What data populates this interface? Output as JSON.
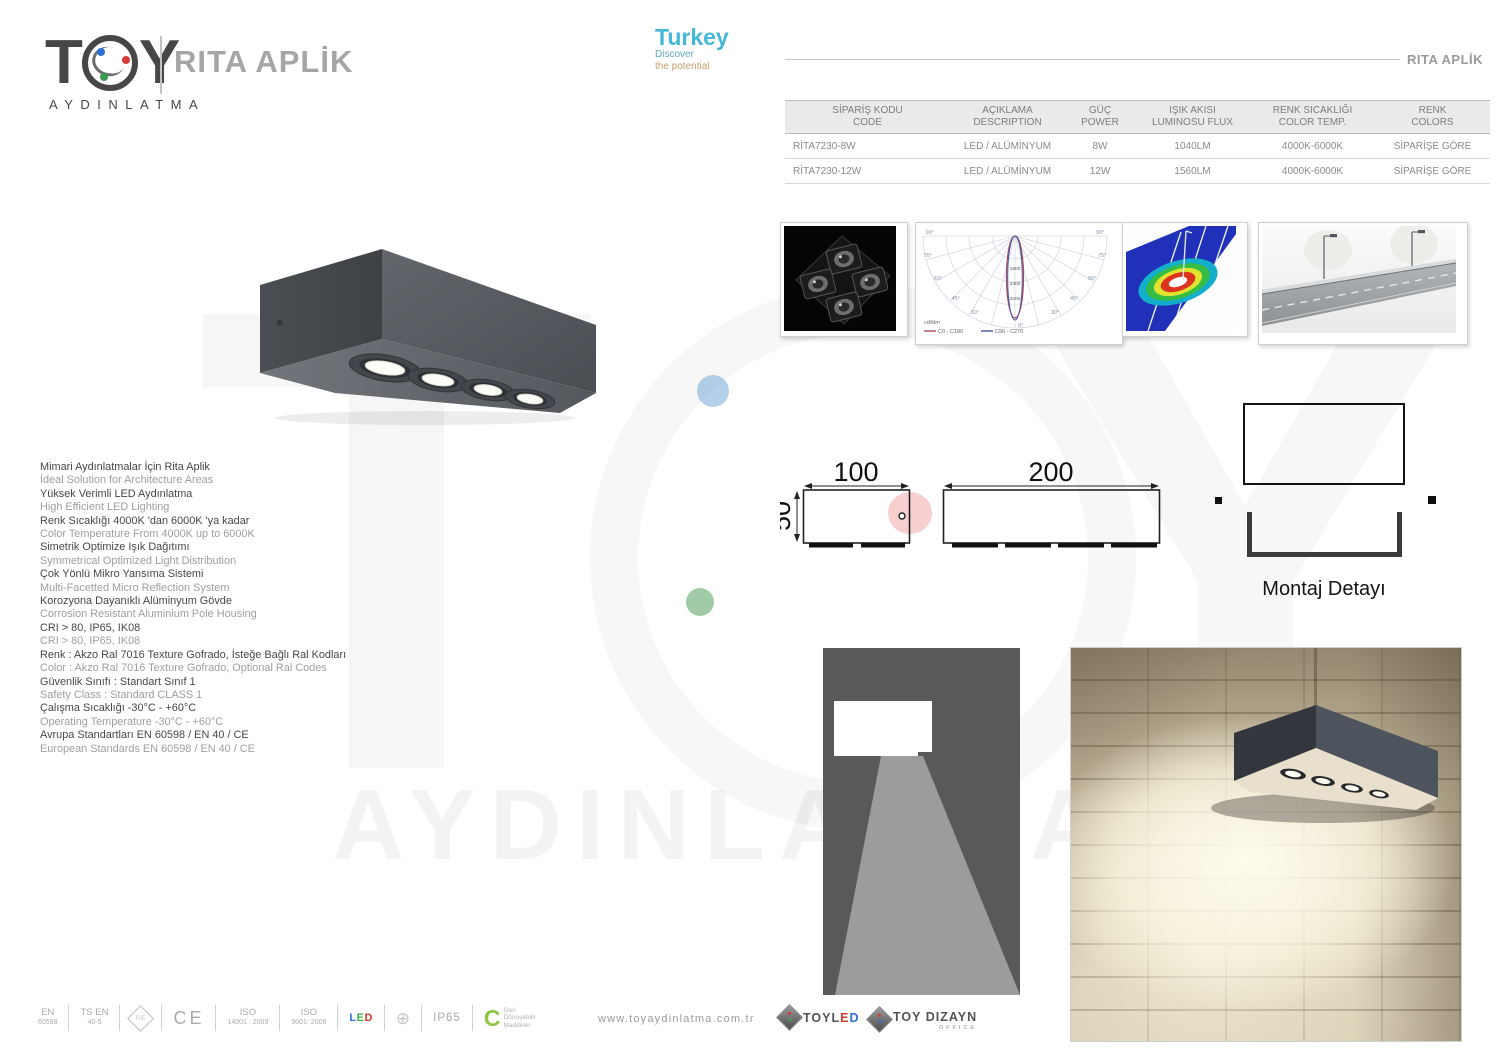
{
  "header": {
    "brand_t": "T",
    "brand_y": "Y",
    "brand_sub": "AYDINLATMA",
    "product_title": "RITA APLİK",
    "top_right_label": "RITA APLİK",
    "turkey": {
      "title": "Turkey",
      "tagline1": "Discover",
      "tagline2": "the potential"
    }
  },
  "spec_table": {
    "headers": [
      {
        "tr": "SİPARİŞ KODU",
        "en": "CODE"
      },
      {
        "tr": "AÇIKLAMA",
        "en": "DESCRIPTION"
      },
      {
        "tr": "GÜÇ",
        "en": "POWER"
      },
      {
        "tr": "IŞIK AKISI",
        "en": "LUMINOSU FLUX"
      },
      {
        "tr": "RENK SICAKLIĞI",
        "en": "COLOR TEMP."
      },
      {
        "tr": "RENK",
        "en": "COLORS"
      }
    ],
    "rows": [
      [
        "RİTA7230-8W",
        "LED / ALÜMİNYUM",
        "8W",
        "1040LM",
        "4000K-6000K",
        "SİPARİŞE GÖRE"
      ],
      [
        "RİTA7230-12W",
        "LED / ALÜMİNYUM",
        "12W",
        "1560LM",
        "4000K-6000K",
        "SİPARİŞE GÖRE"
      ]
    ]
  },
  "polar_chart": {
    "type": "polar-photometric",
    "unit": "cd/klm",
    "l90": "90°",
    "l75": "75°",
    "l60": "60°",
    "l45": "45°",
    "l30": "30°",
    "l0": "0°",
    "v1": "1600",
    "v2": "2400",
    "v3": "3200",
    "legend1": "C0 - C180",
    "legend2": "C90 - C270",
    "legend1_color": "#a94758",
    "legend2_color": "#4455a8"
  },
  "features": [
    {
      "t": "Mimari Aydınlatmalar İçin Rita Aplik"
    },
    {
      "t": "İdeal Solution for Architecture Areas"
    },
    {
      "t": "Yüksek Verimli LED Aydınlatma"
    },
    {
      "t": "High Efficient LED Lighting"
    },
    {
      "t": "Renk Sıcaklığı 4000K 'dan 6000K 'ya kadar"
    },
    {
      "t": "Color Temperature From 4000K up to 6000K"
    },
    {
      "t": "Simetrik Optimize Işık Dağıtımı"
    },
    {
      "t": "Symmetrical Optimized Light Distribution"
    },
    {
      "t": "Çok Yönlü Mikro Yansıma Sistemi"
    },
    {
      "t": "Multi-Facetted Micro Reflection System"
    },
    {
      "t": "Korozyona Dayanıklı Alüminyum Gövde"
    },
    {
      "t": "Corrosion Resistant Aluminium Pole Housing"
    },
    {
      "t": "CRI > 80, IP65, IK08"
    },
    {
      "t": "CRI > 80, IP65, IK08"
    },
    {
      "t": "Renk : Akzo Ral 7016 Texture Gofrado, İsteğe Bağlı Ral Kodları"
    },
    {
      "t": "Color : Akzo Ral 7016 Texture Gofrado, Optional Ral Codes"
    },
    {
      "t": "Güvenlik Sınıfı : Standart Sınıf 1"
    },
    {
      "t": "Safety Class : Standard CLASS 1"
    },
    {
      "t": "Çalışma Sıcaklığı  -30°C - +60°C"
    },
    {
      "t": "Operating Temperature -30°C - +60°C"
    },
    {
      "t": "Avrupa Standartları EN 60598 / EN 40 / CE"
    },
    {
      "t": "European Standards EN 60598 / EN 40 / CE"
    }
  ],
  "dimensions": {
    "small_width": "100",
    "large_width": "200",
    "height": "50"
  },
  "mounting_label": "Montaj Detayı",
  "watermark": {
    "word": "AYDINLATMA"
  },
  "footer": {
    "certs": {
      "en": {
        "l1": "EN",
        "l2": "60598"
      },
      "tsen": {
        "l1": "TS EN",
        "l2": "40-5"
      },
      "tse": "TSE",
      "ce": "CE",
      "iso1": {
        "l1": "ISO",
        "l2": "14001 : 2009"
      },
      "iso2": {
        "l1": "ISO",
        "l2": "9001: 2008"
      },
      "led": {
        "l": "L",
        "e": "E",
        "d": "D"
      },
      "ground": "⊕",
      "ip": "IP65",
      "recycle": {
        "c": "C",
        "l1": "Geri",
        "l2": "Dönüşebilir",
        "l3": "Maddeler"
      }
    },
    "website": "www.toyaydinlatma.com.tr",
    "brand_logos": {
      "toyled": {
        "pre": "TOYL",
        "e": "E",
        "d": "D"
      },
      "toydizayn": {
        "name": "TOY DIZAYN",
        "sub": "OFFICE"
      }
    }
  },
  "colors": {
    "accent_cyan": "#45b8d8",
    "led_l": "#2d6fd6",
    "led_e": "#3dae49",
    "led_d": "#d6382d",
    "recycle_green": "#8dc63f",
    "toyled_e": "#d23c30",
    "toyled_d": "#2d6fd6"
  }
}
